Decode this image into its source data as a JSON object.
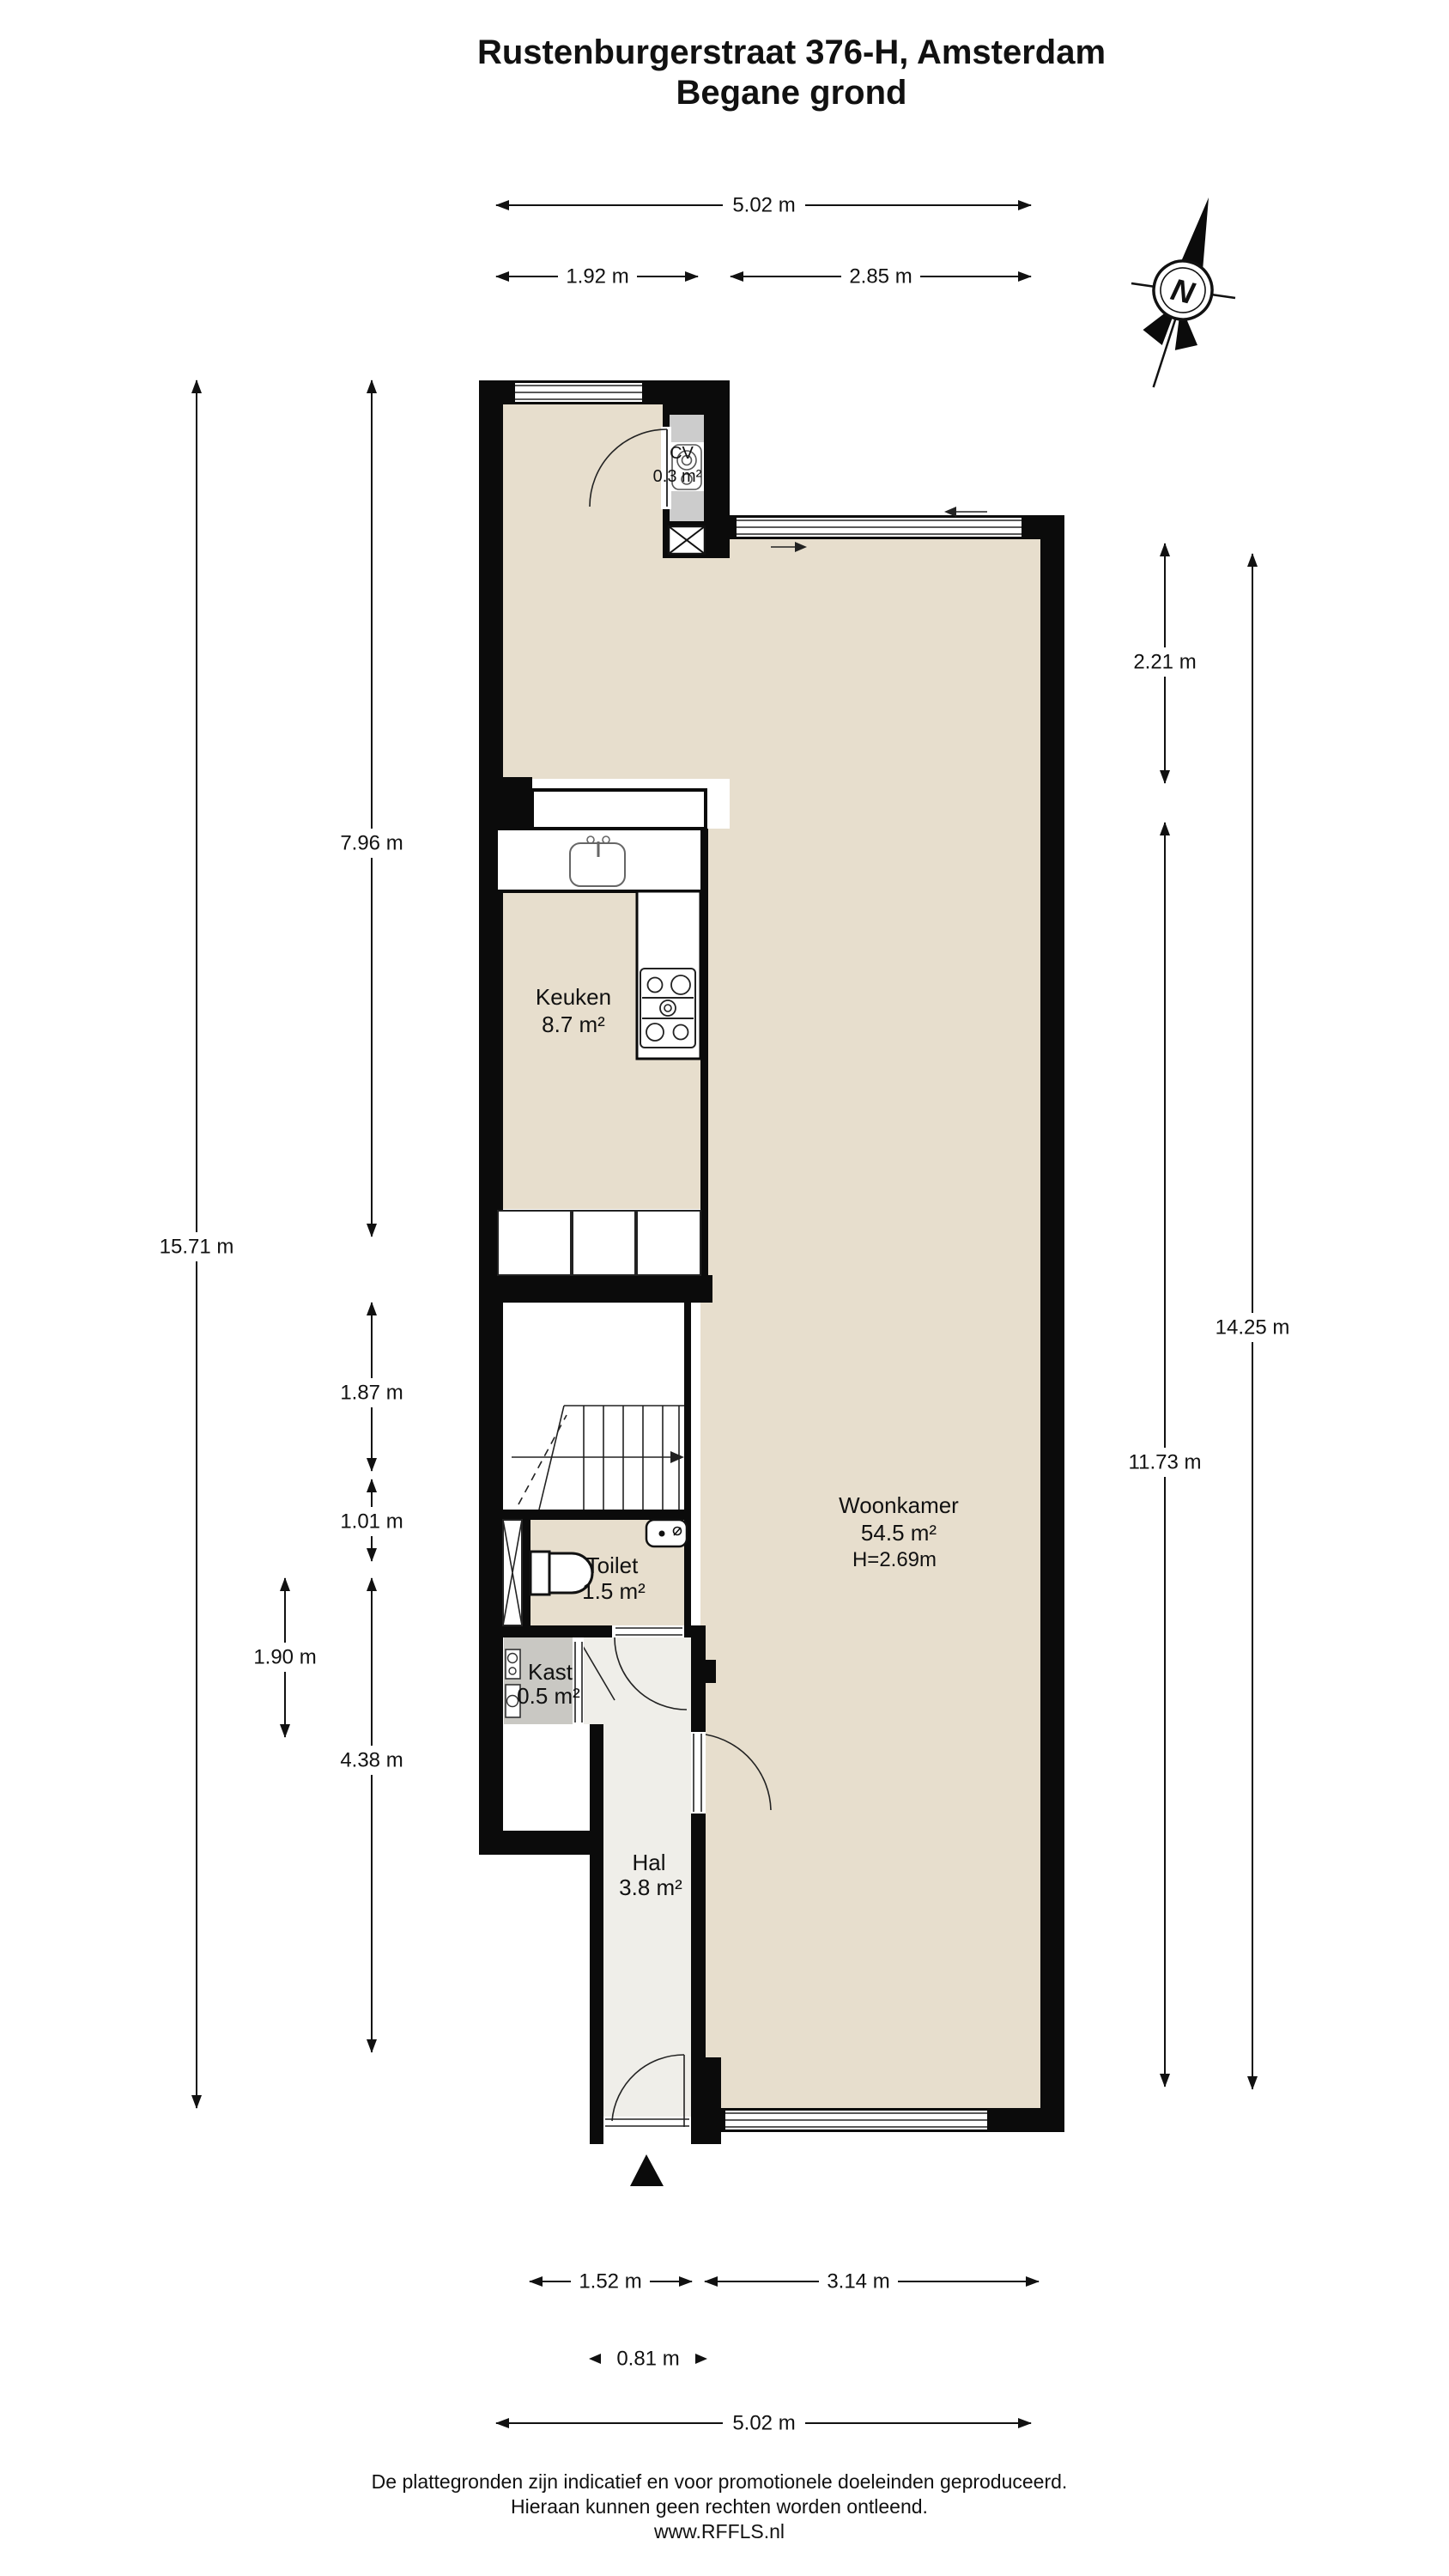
{
  "title": {
    "line1": "Rustenburgerstraat 376-H, Amsterdam",
    "line2": "Begane grond"
  },
  "compass": {
    "north_label": "N"
  },
  "rooms": {
    "cv": {
      "name": "CV",
      "area": "0.3 m²"
    },
    "keuken": {
      "name": "Keuken",
      "area": "8.7 m²"
    },
    "woonkamer": {
      "name": "Woonkamer",
      "area": "54.5 m²",
      "ceiling_height": "H=2.69m"
    },
    "toilet": {
      "name": "Toilet",
      "area": "1.5 m²"
    },
    "kast": {
      "name": "Kast",
      "area": "0.5 m²"
    },
    "hal": {
      "name": "Hal",
      "area": "3.8 m²"
    }
  },
  "dimensions": {
    "top_total": "5.02 m",
    "top_left": "1.92 m",
    "top_right": "2.85 m",
    "left_total": "15.71 m",
    "left_keuken": "7.96 m",
    "left_stairs": "1.87 m",
    "left_toilet": "1.01 m",
    "left_kast": "1.90 m",
    "left_hal": "4.38 m",
    "right_upper": "2.21 m",
    "right_woonkamer": "11.73 m",
    "right_total": "14.25 m",
    "bottom_hal": "1.52 m",
    "bottom_woonkamer": "3.14 m",
    "bottom_door": "0.81 m",
    "bottom_total": "5.02 m"
  },
  "footer": {
    "line1": "De plattegronden zijn indicatief en voor promotionele doeleinden geproduceerd.",
    "line2": "Hieraan kunnen geen rechten worden ontleend.",
    "line3": "www.RFFLS.nl"
  },
  "colors": {
    "wall": "#0b0b0b",
    "floor_beige": "#e7decd",
    "floor_light": "#efeee9",
    "closet_gray": "#c9c8c3"
  }
}
